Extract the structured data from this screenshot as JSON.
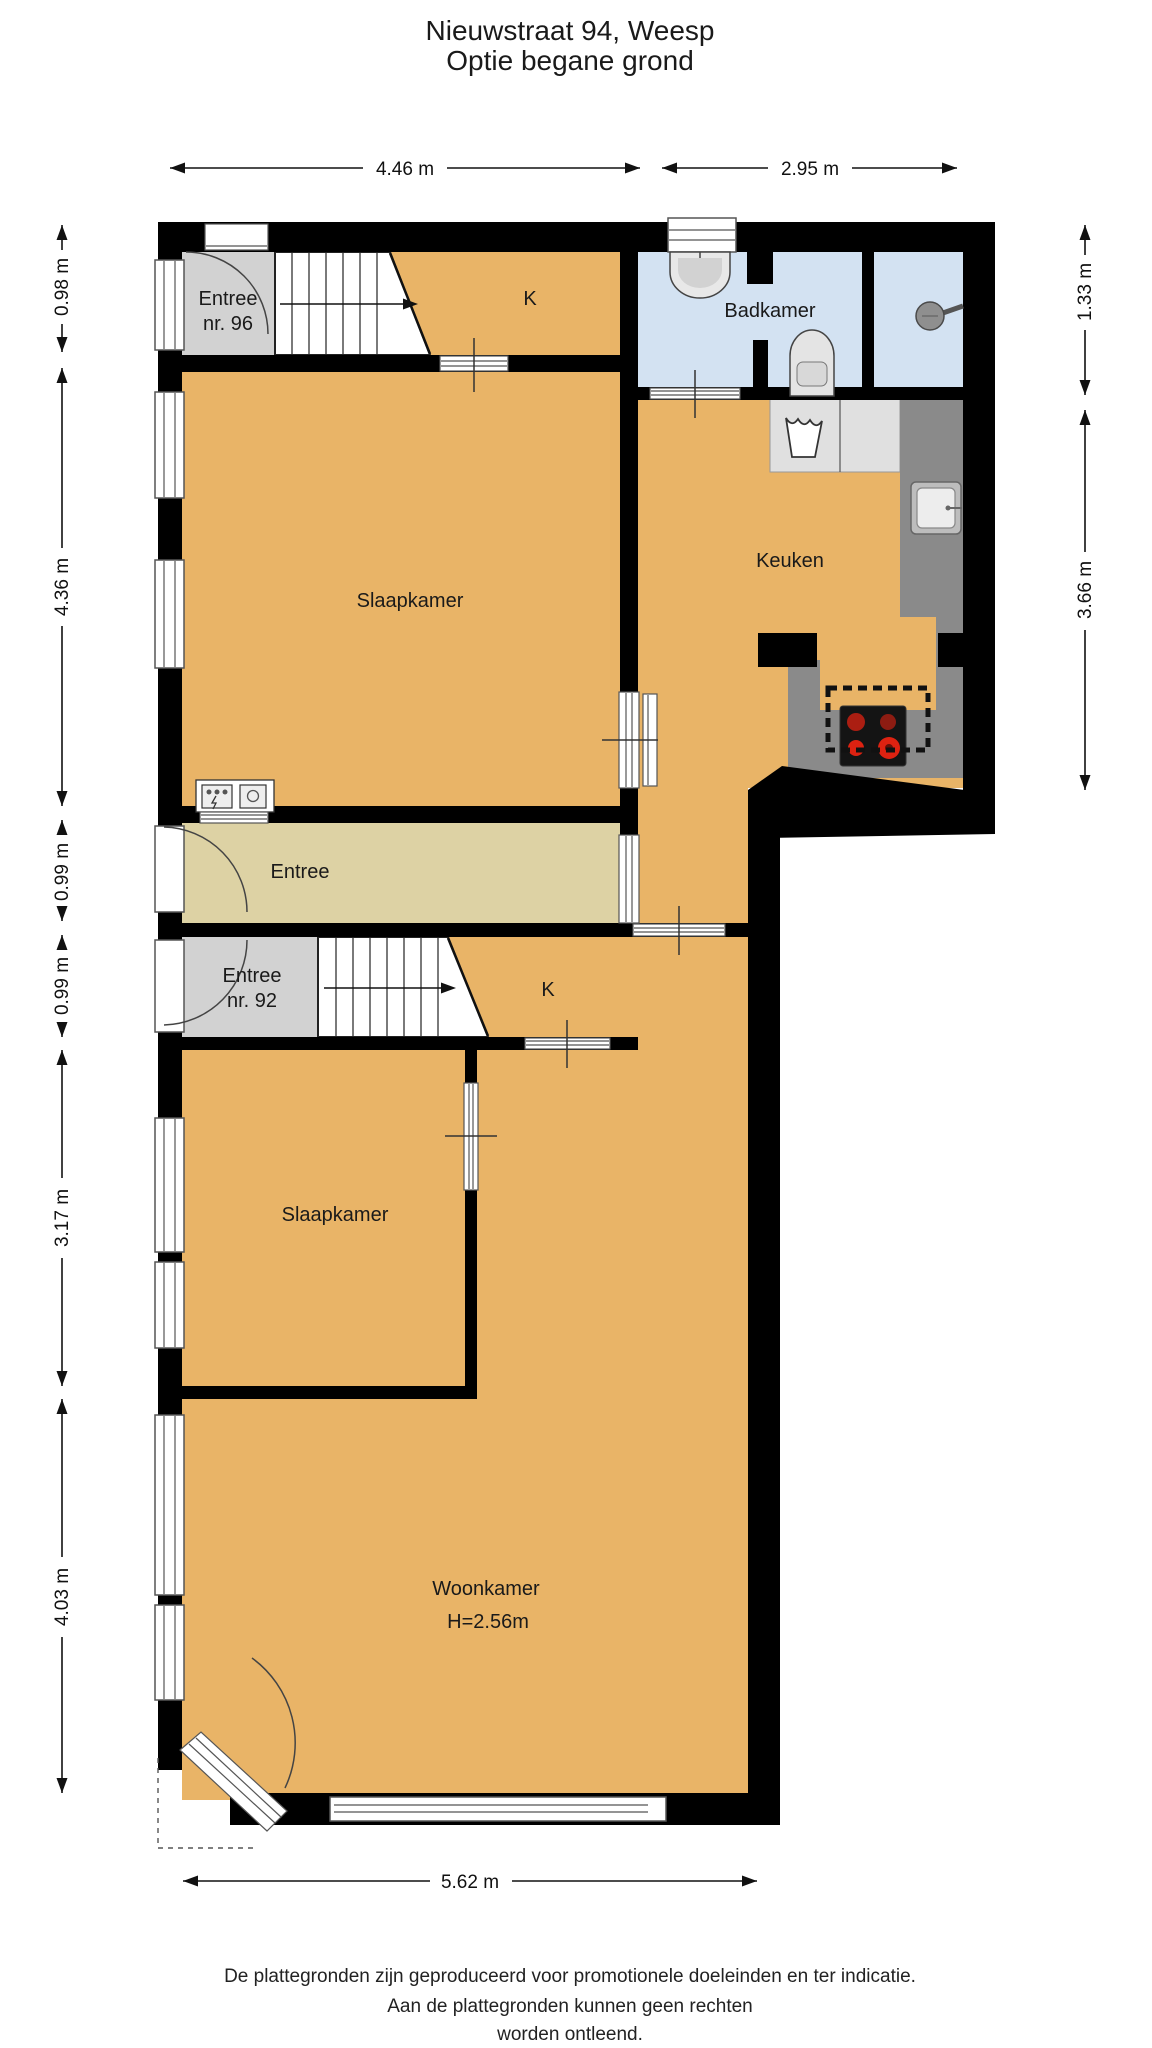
{
  "title": {
    "line1": "Nieuwstraat 94, Weesp",
    "line2": "Optie begane grond"
  },
  "rooms": {
    "entree96": {
      "line1": "Entree",
      "line2": "nr. 96"
    },
    "k_top": "K",
    "badkamer": "Badkamer",
    "slaapkamer1": "Slaapkamer",
    "keuken": "Keuken",
    "entree_hal": "Entree",
    "entree92": {
      "line1": "Entree",
      "line2": "nr. 92"
    },
    "k_92": "K",
    "slaapkamer2": "Slaapkamer",
    "woonkamer": {
      "line1": "Woonkamer",
      "line2": "H=2.56m"
    }
  },
  "dimensions": {
    "top": [
      "4.46 m",
      "2.95 m"
    ],
    "left": [
      "0.98 m",
      "4.36 m",
      "0.99 m",
      "0.99 m",
      "3.17 m",
      "4.03 m"
    ],
    "right": [
      "1.33 m",
      "3.66 m"
    ],
    "bottom": [
      "5.62 m"
    ]
  },
  "footer": {
    "line1": "De plattegronden zijn geproduceerd voor promotionele doeleinden en ter indicatie.",
    "line2": "Aan de plattegronden kunnen geen rechten",
    "line3": "worden ontleend."
  },
  "colors": {
    "room_orange": "#e9b467",
    "hall_beige": "#ddd2a4",
    "entry_gray": "#d2d2d2",
    "bath_blue": "#d3e2f2",
    "counter_dark": "#8a8a8a",
    "counter_light": "#e0e0e0",
    "wall": "#000000",
    "burner_red": "#dd2211"
  }
}
